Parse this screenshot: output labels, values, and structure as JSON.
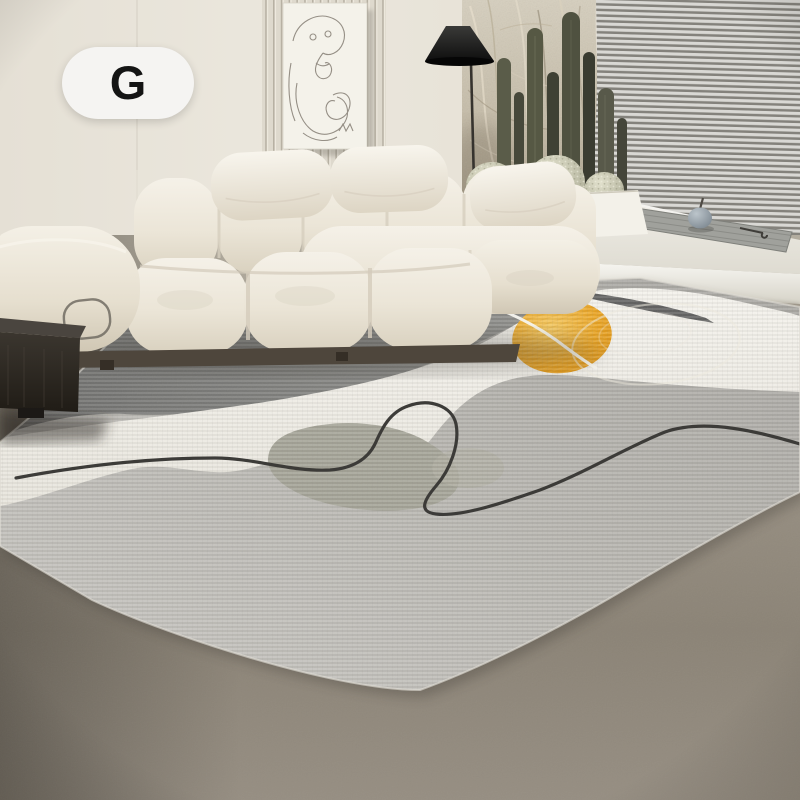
{
  "badge": {
    "label": "G"
  },
  "colors": {
    "badge-bg": "#f5f4f2",
    "badge-text": "#141414",
    "wall": "#e8e3d9",
    "slat-panel": "#ded9cd",
    "art-canvas": "#f4f2ea",
    "art-line": "#8b857b",
    "pampas": "#c9c1ae",
    "blinds-light": "#ecebe7",
    "blinds-dark": "#8b8983",
    "lamp": "#111111",
    "cactus": "#4c4e3d",
    "cactus-ball": "#cfcfba",
    "planter": "#f3f1e9",
    "platform": "#ebe9e1",
    "mat": "#a0a19c",
    "sofa": "#ece7db",
    "sofa-shadow": "#d5cdbc",
    "floor": "#8f8779",
    "side-table": "#322d27",
    "rug-base": "#b9b7b1",
    "rug-dark": "#7a7a77",
    "rug-white": "#f2f0e9",
    "rug-sage": "#a3a295",
    "rug-accent-yellow": "#eca81f",
    "rug-line": "#3c3b38"
  }
}
